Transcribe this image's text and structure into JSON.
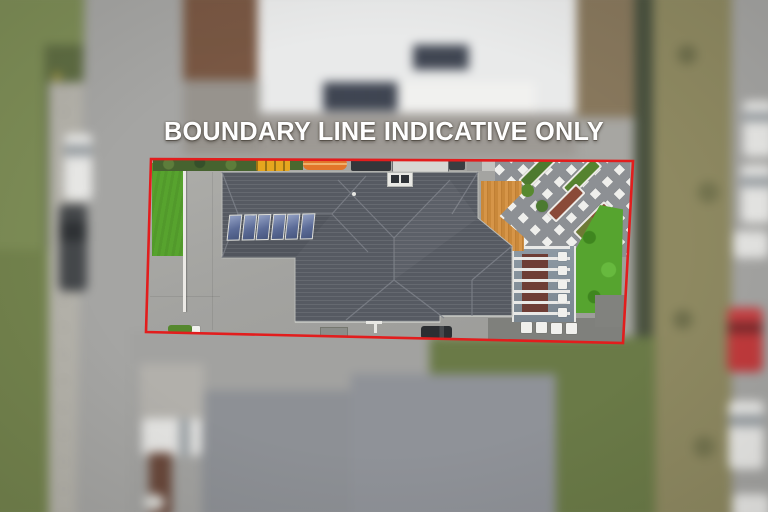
{
  "overlay": {
    "caption": "BOUNDARY LINE INDICATIVE ONLY",
    "caption_color": "#ffffff",
    "boundary_color": "#e21d1d"
  },
  "scene": {
    "type": "aerial-drone-photo",
    "description": "Top-down aerial photo of a residential lot outlined with an indicative red boundary; surroundings are tilt-shift blurred",
    "property": {
      "roof_color": "#565a62",
      "solar_panel_count": 6,
      "features": [
        "hip tile roof",
        "solar panel array",
        "skylight",
        "timber deck",
        "diagonal white paver patio",
        "raised garden planters",
        "louvre pergola",
        "bright lawn strips",
        "concrete driveway",
        "kayak and trailers along fence",
        "parked dark car"
      ]
    },
    "surroundings": {
      "top": "neighbouring house with white roof, solar panels and garage",
      "bottom": "neighbouring house with grey roof, lawn and white parked car",
      "left": "street with white and dark parked cars, footpath and grass berm",
      "right": "grass verge and road with parked cars"
    },
    "vehicles_right_road": [
      "white",
      "white",
      "white",
      "red",
      "white",
      "white"
    ],
    "palette": {
      "road": "#a5a5a3",
      "berm_grass": "#75854f",
      "verge_grass": "#8e8961",
      "bright_lawn": "#58a430",
      "deck_timber": "#cb8a3c",
      "paving": "#8d9094",
      "paver_white": "#efefec",
      "neighbour_roof_top": "#e9eaea",
      "neighbour_roof_bottom": "#8e9296"
    }
  }
}
